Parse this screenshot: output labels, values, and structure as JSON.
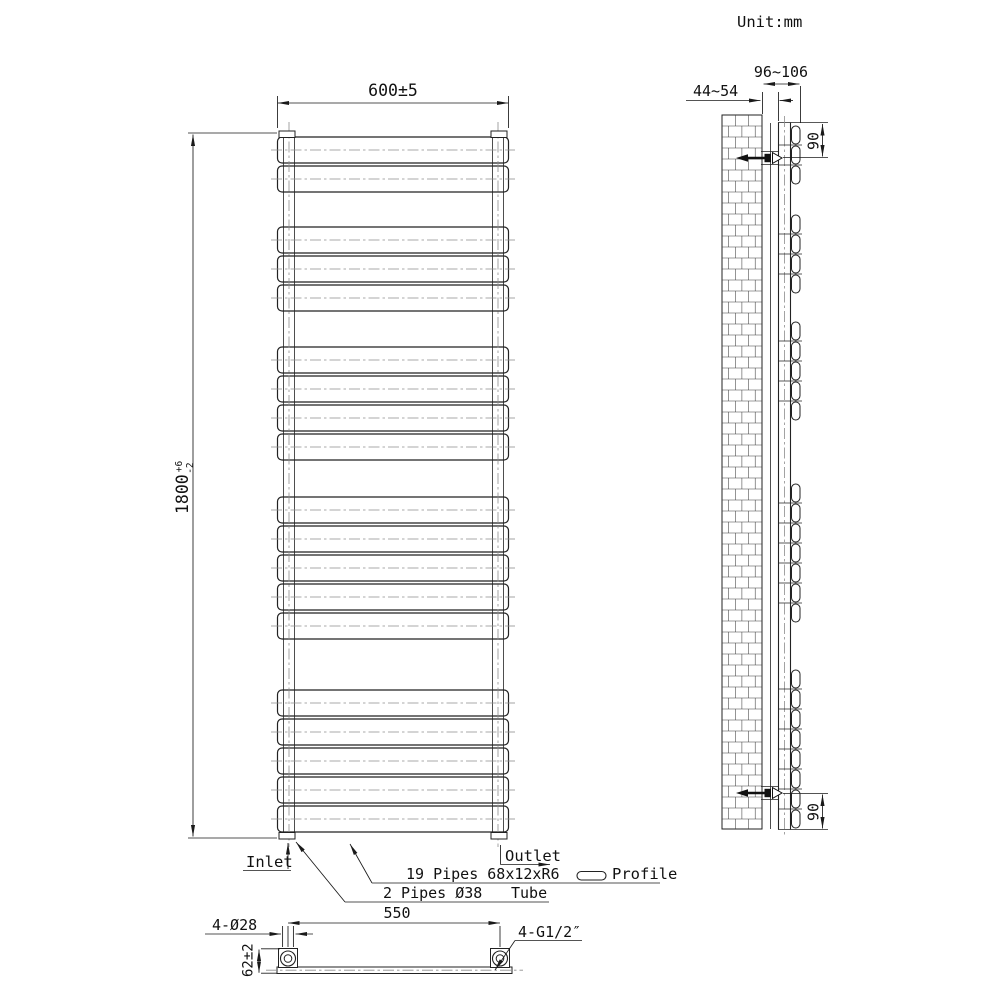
{
  "unit_label": "Unit:mm",
  "front_view": {
    "width_dim": "600±5",
    "height_dim": "1800",
    "height_tol_plus": "+6",
    "height_tol_minus": "-2",
    "panel_count": 19,
    "panel_groups": [
      2,
      3,
      4,
      5,
      5
    ],
    "inlet_label": "Inlet",
    "outlet_label": "Outlet",
    "panel_spec_label": "19 Pipes 68x12xR6",
    "profile_label": "Profile",
    "tube_spec_label": "2 Pipes Ø38",
    "tube_label": "Tube"
  },
  "side_view": {
    "bracket_depth_dim": "44~54",
    "total_depth_dim": "96~106",
    "top_bracket_offset_dim": "90",
    "bottom_bracket_offset_dim": "90",
    "panel_groups": [
      3,
      4,
      5,
      7,
      8
    ]
  },
  "bottom_view": {
    "pipe_centres_dim": "550",
    "holes_dim": "4-Ø28",
    "connection_height_dim": "62±2",
    "thread_dim": "4-G1/2″"
  },
  "colors": {
    "line": "#222222",
    "centerline": "#8d8d8d",
    "background": "#ffffff"
  }
}
